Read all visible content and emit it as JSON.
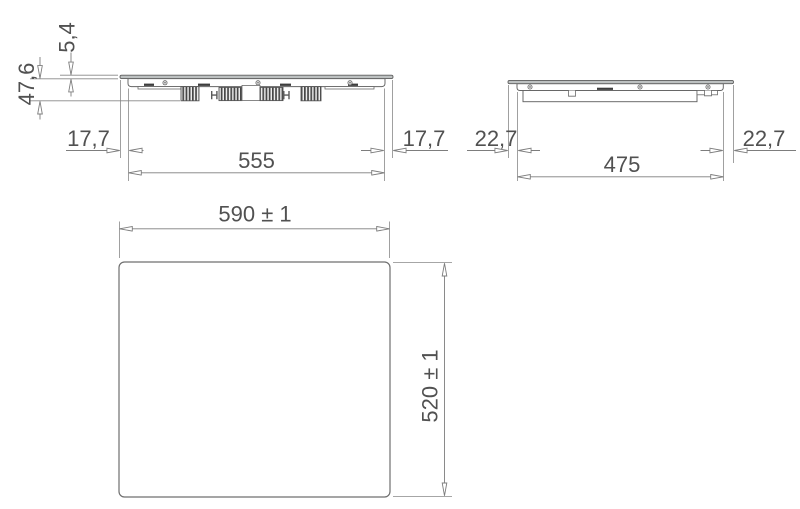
{
  "drawing": {
    "type": "technical-dimension-drawing",
    "units": "mm",
    "colors": {
      "line_gray": "#7d7d7d",
      "device_gray": "#646464",
      "label_gray": "#515151",
      "glass_fill": "#bdc1c1",
      "detail_dark": "#3d3d3d",
      "fin_dark": "#474747"
    },
    "views": {
      "front": {
        "glass_thickness": "5,4",
        "installation_height": "47,6",
        "left_overhang": "17,7",
        "body_width": "555",
        "right_overhang": "17,7"
      },
      "side": {
        "left_overhang": "22,7",
        "body_depth": "475",
        "right_overhang": "22,7"
      },
      "plan": {
        "overall_width": "590 ± 1",
        "overall_depth": "520 ± 1"
      }
    }
  }
}
